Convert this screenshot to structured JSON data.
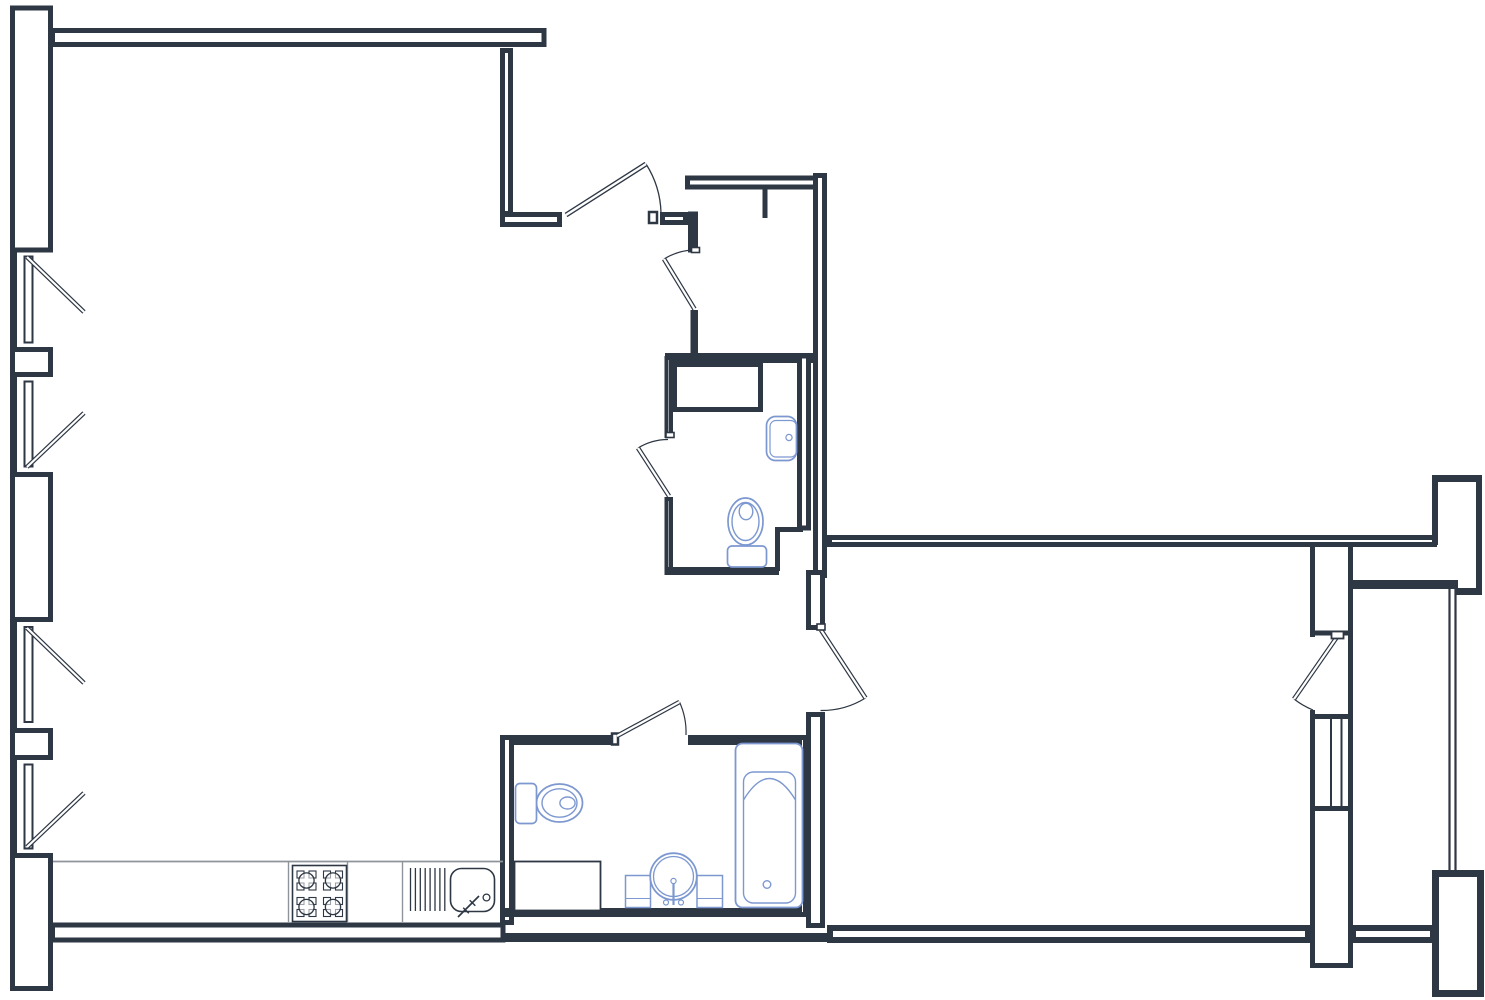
{
  "canvas": {
    "width": 1485,
    "height": 1000
  },
  "colors": {
    "background": "#ffffff",
    "wall": "#2e3744",
    "fixture": "#7d98d0",
    "counter": "#8f949b"
  },
  "plan": {
    "type": "apartment-floor-plan",
    "left_wall_windows": 4,
    "balcony_windows": 1,
    "loggia_glazing_panels": 1,
    "doors": 6,
    "fixtures": [
      "stove-4-burner",
      "dish-drainer",
      "kitchen-sink",
      "washing-machine",
      "vent-duct",
      "wall-sink",
      "toilet-upper-bath",
      "toilet-lower-bath",
      "round-sink-with-cabinet",
      "bathtub"
    ]
  }
}
